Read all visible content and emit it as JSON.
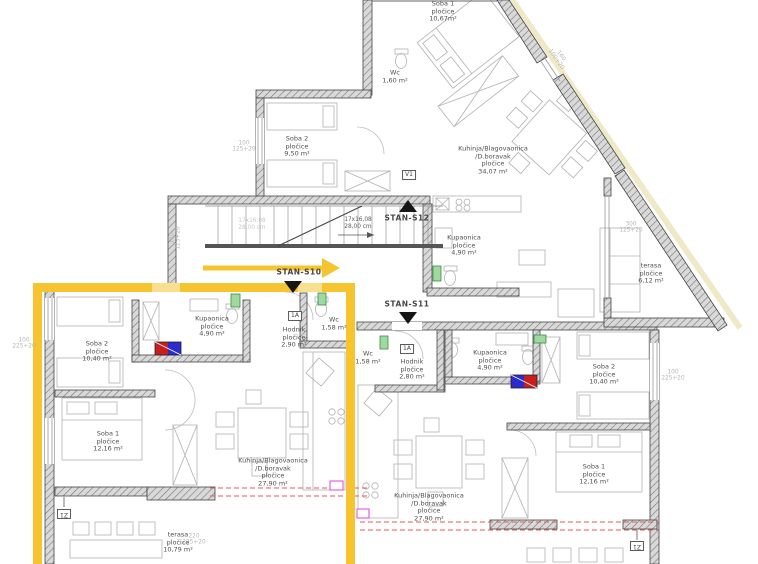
{
  "plan": {
    "title": "floor plan",
    "colors": {
      "highlight_yellow": "#F5C42F",
      "wall_dark": "#4a4a4a",
      "furniture_gray": "#b1b1b1",
      "section_red": "#E05A5A",
      "washer_blue": "#2B2BD0",
      "washer_red": "#C81E1E",
      "vent_green": "#9fd9a0",
      "fitting_magenta": "#E33FE3"
    }
  },
  "apartments": {
    "s10": {
      "id": "STAN-S10",
      "entry_label": "1A",
      "window_label": "Z1",
      "rooms": {
        "soba2": {
          "name": "Soba 2",
          "finish": "pločice",
          "area": "10,40 m²"
        },
        "kupaonica": {
          "name": "Kupaonica",
          "finish": "pločice",
          "area": "4,90 m²"
        },
        "hodnik": {
          "name": "Hodnik",
          "finish": "pločice",
          "area": "2,90 m²"
        },
        "wc": {
          "name": "Wc",
          "area": "1,58 m²"
        },
        "soba1": {
          "name": "Soba 1",
          "finish": "pločice",
          "area": "12,16 m²"
        },
        "kuhinja": {
          "name": "Kuhinja/Blagovaonica",
          "name2": "/D.boravak",
          "finish": "pločice",
          "area": "27,90 m²"
        },
        "terasa": {
          "name": "terasa",
          "finish": "pločice",
          "area": "10,79 m²"
        }
      }
    },
    "s11": {
      "id": "STAN-S11",
      "entry_label": "1A",
      "window_label": "Z1",
      "rooms": {
        "wc": {
          "name": "Wc",
          "area": "1,58 m²"
        },
        "hodnik": {
          "name": "Hodnik",
          "finish": "pločice",
          "area": "2,80 m²"
        },
        "kupaonica": {
          "name": "Kupaonica",
          "finish": "pločice",
          "area": "4,90 m²"
        },
        "soba2": {
          "name": "Soba 2",
          "finish": "pločice",
          "area": "10,40 m²"
        },
        "soba1": {
          "name": "Soba 1",
          "finish": "pločice",
          "area": "12,16 m²"
        },
        "kuhinja": {
          "name": "Kuhinja/Blagovaonica",
          "name2": "/D.boravak",
          "finish": "pločice",
          "area": "27,90 m²"
        }
      }
    },
    "s12": {
      "id": "STAN-S12",
      "vent_label": "V1",
      "rooms": {
        "soba1": {
          "name": "Soba 1",
          "finish": "pločice",
          "area": "10,67m²"
        },
        "wc": {
          "name": "Wc",
          "area": "1,60 m²"
        },
        "soba2": {
          "name": "Soba 2",
          "finish": "pločice",
          "area": "9,50 m²"
        },
        "kuhinja": {
          "name": "Kuhinja/Blagovaonica",
          "name2": "/D.boravak",
          "finish": "pločice",
          "area": "34,07 m²"
        },
        "kupaonica": {
          "name": "Kupaonica",
          "finish": "pločice",
          "area": "4,90 m²"
        },
        "terasa": {
          "name": "terasa",
          "finish": "pločice",
          "area": "6,12 m²"
        }
      }
    }
  },
  "stairs": {
    "run": "17x16,08",
    "tread": "28,00 cm"
  },
  "dimensions": {
    "d1": {
      "a": "100",
      "b": "125+20"
    },
    "d2": {
      "a": "170",
      "b": "125+20"
    },
    "d3": {
      "a": "100",
      "b": "225+20"
    },
    "d4": {
      "a": "220",
      "b": "225+20"
    },
    "d5": {
      "a": "100",
      "b": "225+20"
    },
    "d6": {
      "a": "300",
      "b": "125+20"
    },
    "d7": {
      "a": "160",
      "b": "100+20"
    }
  }
}
